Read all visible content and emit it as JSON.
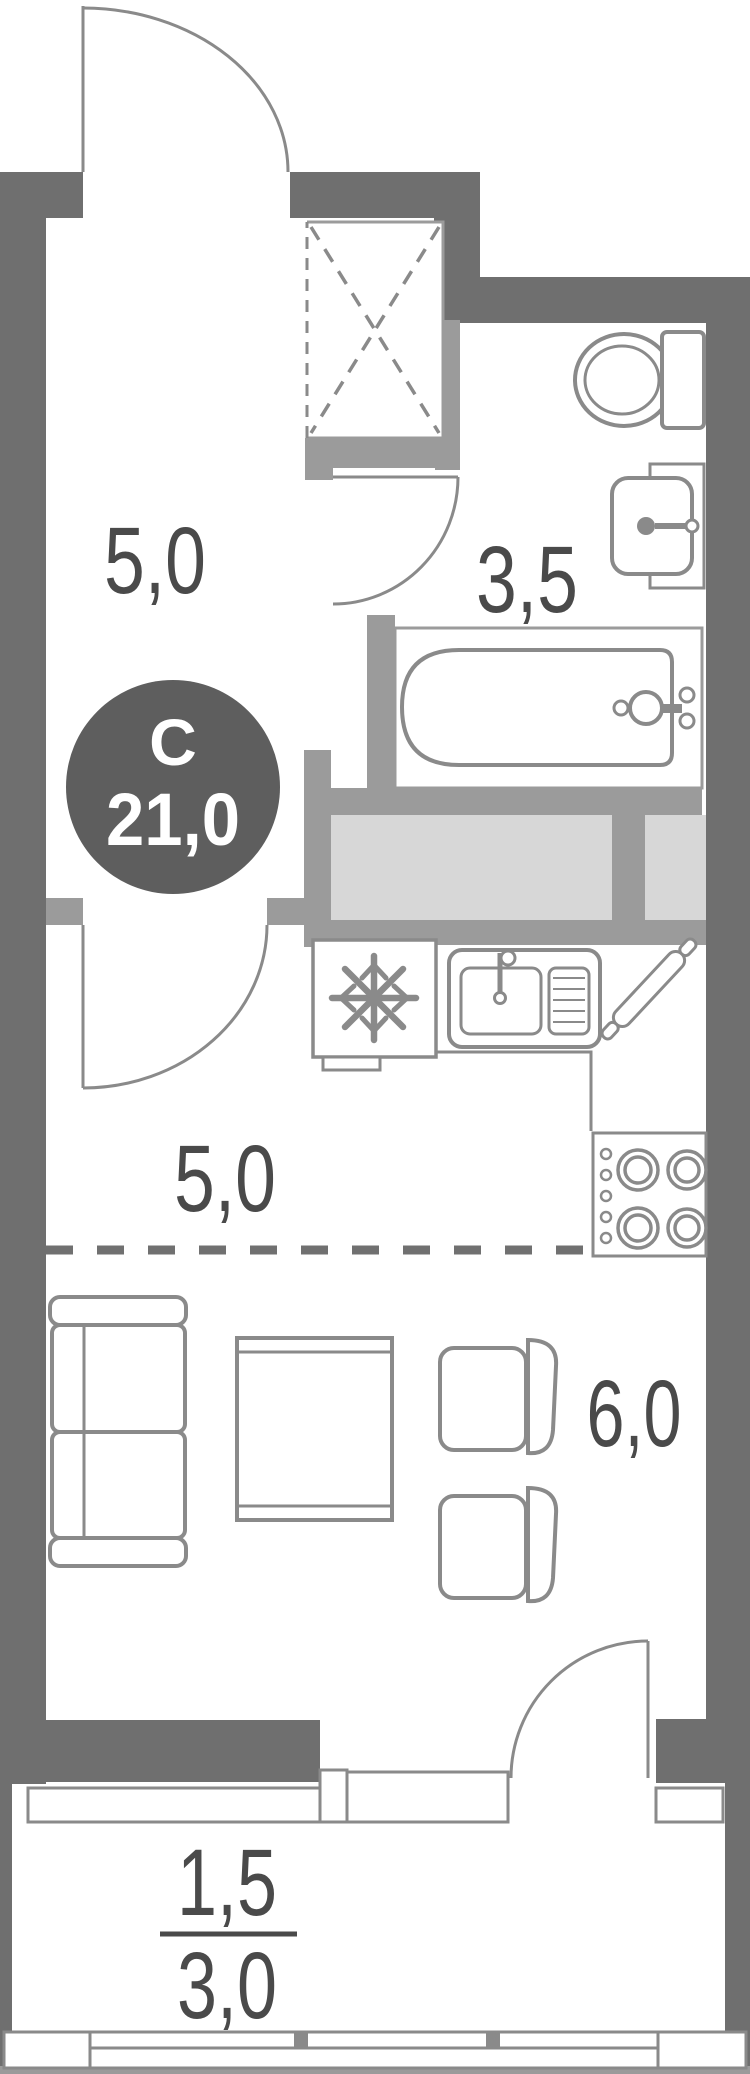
{
  "plan": {
    "title": "studio-apartment-floor-plan",
    "badge": {
      "type": "С",
      "area": "21,0"
    },
    "rooms": {
      "hallway": {
        "name": "hallway",
        "area": "5,0"
      },
      "bathroom": {
        "name": "bathroom",
        "area": "3,5"
      },
      "kitchen": {
        "name": "kitchen",
        "area": "5,0"
      },
      "living": {
        "name": "living-room",
        "area": "6,0"
      },
      "balcony": {
        "name": "balcony",
        "area_reduced": "1,5",
        "area_full": "3,0"
      }
    },
    "fixtures": [
      "entrance-door",
      "wardrobe",
      "toilet",
      "sink",
      "bathtub",
      "fridge",
      "kitchen-sink",
      "rolling-pin",
      "stove",
      "sofa",
      "coffee-table",
      "chair",
      "chair",
      "balcony-door",
      "window",
      "balcony-glazing"
    ],
    "colors": {
      "outer_wall": "#6f6f6f",
      "partition": "#9b9b9b",
      "duct_fill": "#d7d7d7",
      "fixture_stroke": "#8a8a8a",
      "badge_fill": "#5e5e5e",
      "label_text": "#4a4a4a"
    }
  }
}
